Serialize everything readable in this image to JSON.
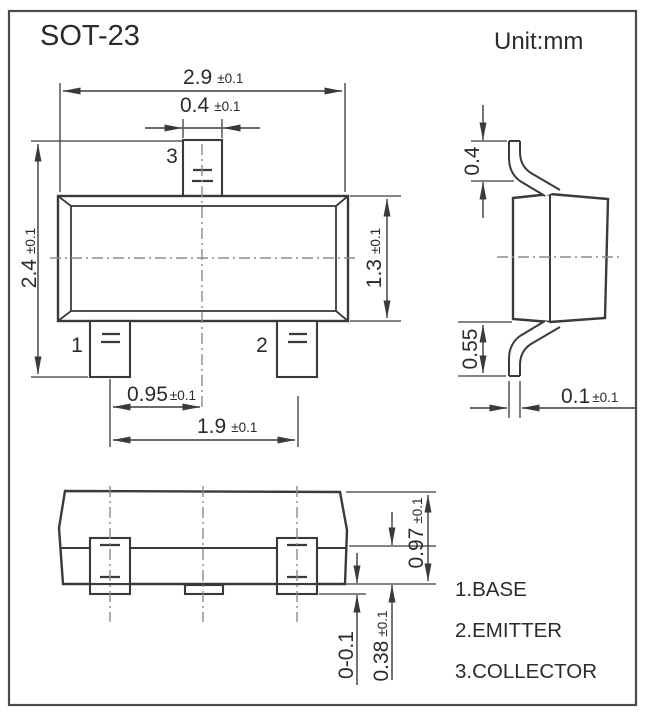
{
  "title": "SOT-23",
  "unit_label": "Unit:mm",
  "top_view": {
    "dim_body_width": {
      "value": "2.9",
      "tol": "±0.1"
    },
    "dim_pin3_width": {
      "value": "0.4",
      "tol": "±0.1"
    },
    "dim_total_height": {
      "value": "2.4",
      "tol": "±0.1"
    },
    "dim_body_height": {
      "value": "1.3",
      "tol": "±0.1"
    },
    "dim_pin_pitch": {
      "value": "0.95",
      "tol": "±0.1"
    },
    "dim_pin_span": {
      "value": "1.9",
      "tol": "±0.1"
    },
    "pin1_label": "1",
    "pin2_label": "2",
    "pin3_label": "3"
  },
  "side_view": {
    "dim_top_lead": {
      "value": "0.4",
      "tol": ""
    },
    "dim_bottom_lead": {
      "value": "0.55",
      "tol": ""
    },
    "dim_lead_thickness": {
      "value": "0.1",
      "tol": "±0.1"
    }
  },
  "front_view": {
    "dim_total_height": {
      "value": "0.97",
      "tol": "±0.1"
    },
    "dim_lead_height": {
      "value": "0.38",
      "tol": "±0.1"
    },
    "dim_standoff": {
      "value": "0-0.1",
      "tol": ""
    }
  },
  "legend": {
    "pin1": "1.BASE",
    "pin2": "2.EMITTER",
    "pin3": "3.COLLECTOR"
  },
  "colors": {
    "line": "#3a3a3a",
    "centerline": "#8c8c8c",
    "text": "#2b2b2b",
    "background": "#ffffff"
  }
}
